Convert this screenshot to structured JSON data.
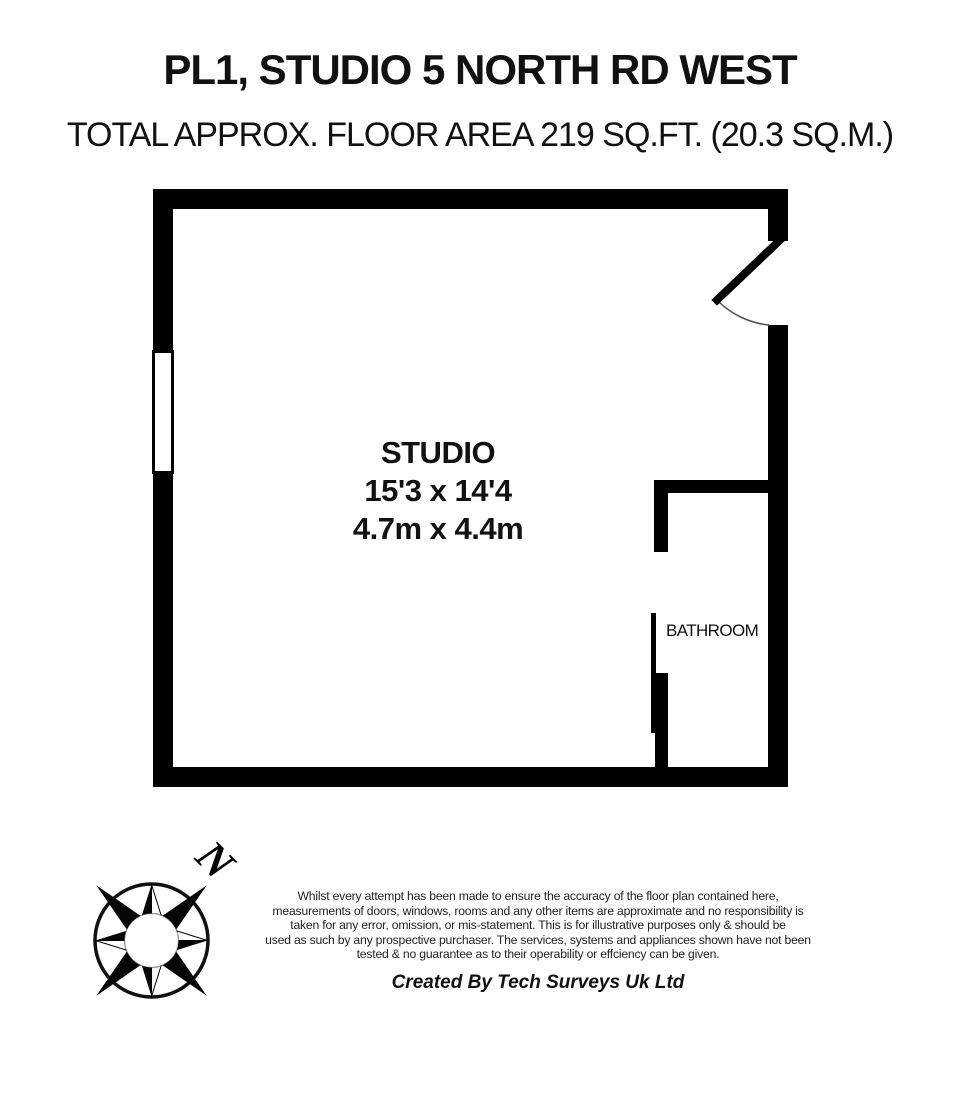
{
  "header": {
    "title": "PL1, STUDIO 5 NORTH RD WEST",
    "subtitle": "TOTAL APPROX. FLOOR AREA 219 SQ.FT. (20.3 SQ.M.)"
  },
  "floorplan": {
    "studio": {
      "name": "STUDIO",
      "size_imperial": "15'3 x 14'4",
      "size_metric": "4.7m x 4.4m"
    },
    "bathroom": {
      "name": "BATHROOM"
    }
  },
  "compass": {
    "north_label": "N"
  },
  "footer": {
    "disclaimer_lines": [
      "Whilst every attempt has been made to ensure the accuracy of the floor plan contained here,",
      "measurements of doors, windows, rooms and any other items are approximate and no responsibility is",
      "taken for any error, omission, or mis-statement. This is for illustrative purposes only & should be",
      "used as such by any prospective purchaser. The services, systems and appliances shown have not been",
      "tested & no guarantee as to their operability or effciency can be given."
    ],
    "credit": "Created By Tech Surveys Uk Ltd"
  },
  "colors": {
    "wall": "#000000",
    "background": "#ffffff",
    "ink": "#111111",
    "muted": "#222222"
  }
}
